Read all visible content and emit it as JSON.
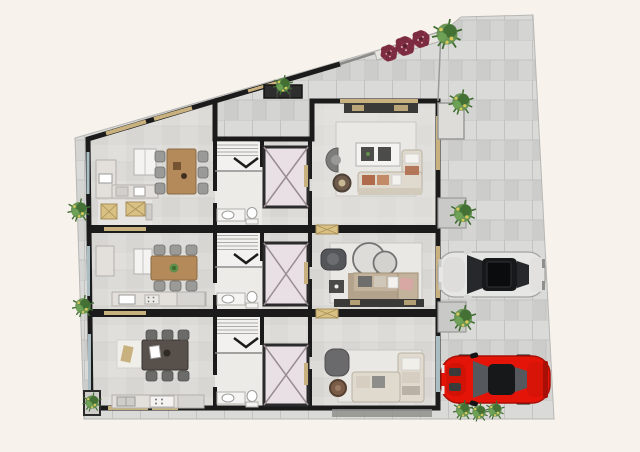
{
  "meta": {
    "type": "architectural-site-plan",
    "description": "Top-view rendered floor plan of a three-unit residential building with slanted site boundary, side driveway, two parked cars and landscaping",
    "units_count": 3,
    "vehicles_count": 2
  },
  "palette": {
    "background": "#f8f2ec",
    "pavement": "#d4d4d2",
    "paver_light": "#dadad8",
    "paver_dark": "#cccccb",
    "paver_line": "#c2c2c0",
    "floor": "#dcdbd7",
    "floor_light": "#e4e2de",
    "wall": "#1b1b1b",
    "window_frame": "#c8b17e",
    "glass": "#a9bdc3",
    "wood": "#b58a5a",
    "wood_dark": "#57504b",
    "counter": "#e3e0db",
    "appliance": "#f4f3f1",
    "chair": "#9a9a98",
    "rug": "#eae8e4",
    "sofa_cream": "#e0d9cd",
    "sofa_beige": "#c3b29c",
    "cushion_rust": "#b06b4c",
    "armchair_gray": "#55565a",
    "elevator_fill": "#e8e0e4",
    "elevator_line": "#9a8d92",
    "stair_fill": "#f2f1ef",
    "plant_green": "#5f8f4a",
    "plant_dark": "#3e6b30",
    "plant_yellow": "#d9c95d",
    "flower": "#8e3549",
    "flower_dark": "#5f2433",
    "planter_box": "#d9c184",
    "car_silver": "#e6e6e5",
    "car_glass": "#26282b",
    "car_red": "#e41508",
    "car_red_dark": "#a80f06",
    "skylight": "#2e2e2e",
    "hedge": "#8f8f8d"
  },
  "site": {
    "areas": [
      {
        "id": "driveway",
        "label": "Paved driveway along the right side"
      },
      {
        "id": "terrace",
        "label": "Paved terrace in upper triangle above core"
      },
      {
        "id": "walkway",
        "label": "Narrow walkway strip along the left side"
      }
    ]
  },
  "building": {
    "units": [
      {
        "id": "unit-1",
        "position": "top",
        "rooms": [
          "kitchen-dining",
          "staircase",
          "bathroom",
          "elevator",
          "living-room",
          "balcony"
        ],
        "furniture": [
          "kitchen counter with sink",
          "tall cabinet",
          "wood dining table with 6 chairs",
          "sideboard",
          "curved armchair",
          "round coffee table",
          "corner sofa with rust cushions",
          "TV console",
          "balcony planter boxes"
        ]
      },
      {
        "id": "unit-2",
        "position": "middle",
        "rooms": [
          "kitchen-dining",
          "staircase",
          "bathroom",
          "elevator",
          "living-room"
        ],
        "furniture": [
          "kitchen counter with sink and cooktop",
          "tall cabinet",
          "wood dining table with 6 chairs and centerpiece plant",
          "dark armchair",
          "nesting round tables",
          "sofa with chaise",
          "dark side table",
          "TV console"
        ]
      },
      {
        "id": "unit-3",
        "position": "bottom",
        "rooms": [
          "kitchen-dining",
          "staircase",
          "bathroom",
          "elevator",
          "living-room"
        ],
        "furniture": [
          "kitchen counter with sink, cooktop and fridge",
          "dark dining table with 6 chairs",
          "area rug",
          "curved cabinet",
          "round pouf",
          "corner sofa in cream"
        ]
      }
    ],
    "circulation": {
      "stair_marker": "chevron-down",
      "elevator_symbol": "crossed-diagonals-square"
    }
  },
  "vehicles": [
    {
      "id": "silver-sedan",
      "body_color_key": "car_silver",
      "orientation": "horizontal, front facing left, dark roof with sunroof"
    },
    {
      "id": "red-coupe",
      "body_color_key": "car_red",
      "orientation": "horizontal, front facing left, dark windshield and rear glass"
    }
  ],
  "landscaping": {
    "left_walkway_shrubs": 2,
    "right_ledge_shrubs": 3,
    "terrace_shrub": 1,
    "roof_edge_flower_clusters": 3,
    "roof_edge_leaf_plant": 1,
    "bottom_hedge_shrubs": 3,
    "planter_boxes": 5
  }
}
